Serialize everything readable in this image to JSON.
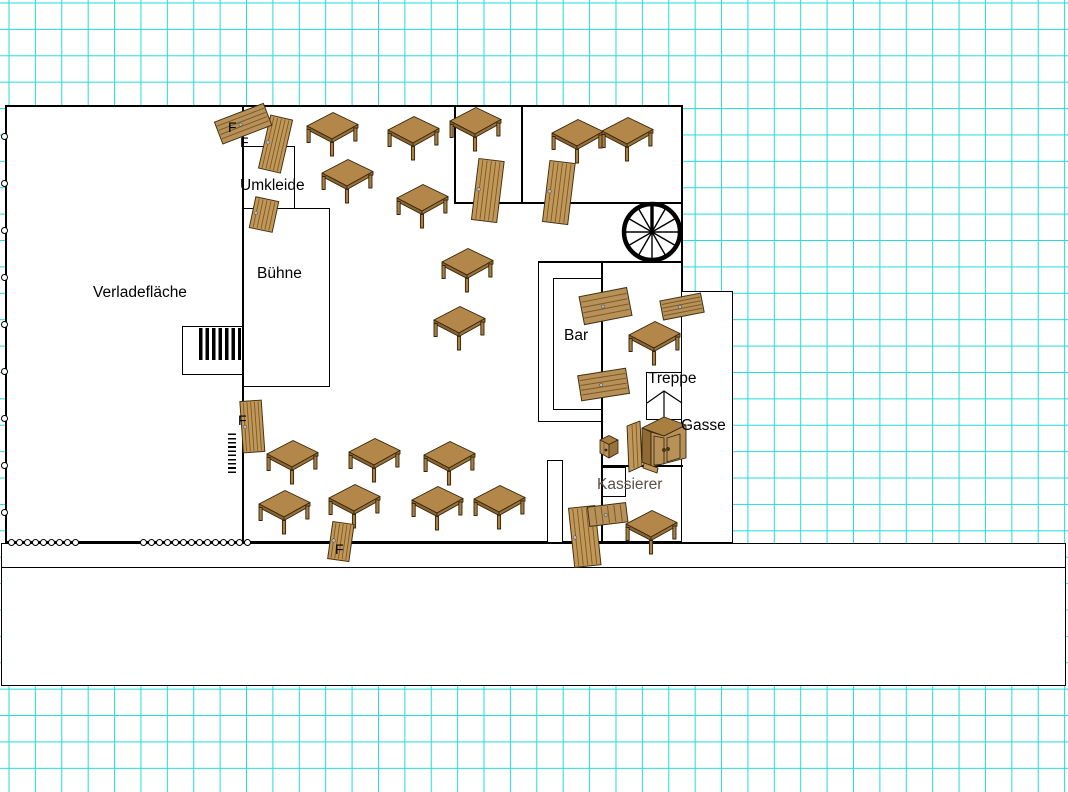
{
  "colors": {
    "grid": "#21dcdc",
    "wood_top": "#b3874a",
    "wood_mid": "#b8905a",
    "wood_door": "#c2985a",
    "wood_dark": "#8a6430",
    "outline": "#33240c",
    "kassierer_text": "#57504b"
  },
  "labels": [
    {
      "id": "verladeflaeche",
      "text": "Verladefläche",
      "x": 93,
      "y": 285,
      "size": 15.5
    },
    {
      "id": "umkleide",
      "text": "Umkleide",
      "x": 240,
      "y": 178,
      "size": 15.5
    },
    {
      "id": "buehne",
      "text": "Bühne",
      "x": 257,
      "y": 266,
      "size": 15.5
    },
    {
      "id": "bar",
      "text": "Bar",
      "x": 564,
      "y": 328,
      "size": 15.5
    },
    {
      "id": "treppe",
      "text": "Treppe",
      "x": 648,
      "y": 371,
      "size": 15.5
    },
    {
      "id": "gasse",
      "text": "Gasse",
      "x": 681,
      "y": 418,
      "size": 15.5
    },
    {
      "id": "kassierer",
      "text": "Kassierer",
      "x": 597,
      "y": 477,
      "size": 15.5,
      "color": "#57504b"
    },
    {
      "id": "f-1",
      "text": "F",
      "x": 228,
      "y": 120,
      "size": 14
    },
    {
      "id": "f-2",
      "text": "F",
      "x": 240,
      "y": 135,
      "size": 14
    },
    {
      "id": "f-3",
      "text": "F",
      "x": 238,
      "y": 413,
      "size": 14
    },
    {
      "id": "f-4",
      "text": "F",
      "x": 335,
      "y": 542,
      "size": 14
    }
  ],
  "furniture": {
    "tables": [
      [
        306,
        111
      ],
      [
        387,
        115
      ],
      [
        449,
        106
      ],
      [
        551,
        118
      ],
      [
        601,
        116
      ],
      [
        321,
        158
      ],
      [
        396,
        183
      ],
      [
        441,
        247
      ],
      [
        433,
        305
      ],
      [
        628,
        320
      ],
      [
        266,
        439
      ],
      [
        348,
        437
      ],
      [
        423,
        440
      ],
      [
        258,
        489
      ],
      [
        328,
        483
      ],
      [
        411,
        485
      ],
      [
        473,
        484
      ],
      [
        625,
        509
      ]
    ],
    "doors": [
      {
        "x": 263,
        "y": 116,
        "w": 24,
        "h": 56,
        "rot": 13
      },
      {
        "x": 251,
        "y": 198,
        "w": 25,
        "h": 33,
        "rot": 12
      },
      {
        "x": 474,
        "y": 159,
        "w": 27,
        "h": 63,
        "rot": 7
      },
      {
        "x": 545,
        "y": 161,
        "w": 27,
        "h": 63,
        "rot": 7
      },
      {
        "x": 241,
        "y": 400,
        "w": 23,
        "h": 53,
        "rot": -4
      },
      {
        "x": 329,
        "y": 522,
        "w": 23,
        "h": 39,
        "rot": 8
      },
      {
        "x": 571,
        "y": 506,
        "w": 28,
        "h": 61,
        "rot": -6
      }
    ],
    "planks": [
      {
        "x": 217,
        "y": 111,
        "w": 54,
        "h": 25,
        "rot": -21,
        "grain": "h"
      },
      {
        "x": 581,
        "y": 291,
        "w": 50,
        "h": 30,
        "rot": -11,
        "grain": "h"
      },
      {
        "x": 579,
        "y": 371,
        "w": 50,
        "h": 27,
        "rot": -9,
        "grain": "h"
      },
      {
        "x": 661,
        "y": 296,
        "w": 43,
        "h": 21,
        "rot": -11,
        "grain": "h"
      },
      {
        "x": 588,
        "y": 504,
        "w": 40,
        "h": 21,
        "rot": -7,
        "grain": "v"
      }
    ],
    "spiral_stair": {
      "cx": 652,
      "cy": 232,
      "r": 28
    },
    "cabinet": {
      "x": 624,
      "y": 412
    },
    "small_box": {
      "x": 599,
      "y": 433
    },
    "stair_arrow": {
      "x": 646,
      "y": 371
    }
  },
  "scallops": [
    {
      "x": 8,
      "y": 539,
      "count": 9
    },
    {
      "x": 140,
      "y": 539,
      "count": 14
    }
  ],
  "wall_marks": {
    "x": 1,
    "y_start": 133,
    "step": 47,
    "count": 9
  }
}
